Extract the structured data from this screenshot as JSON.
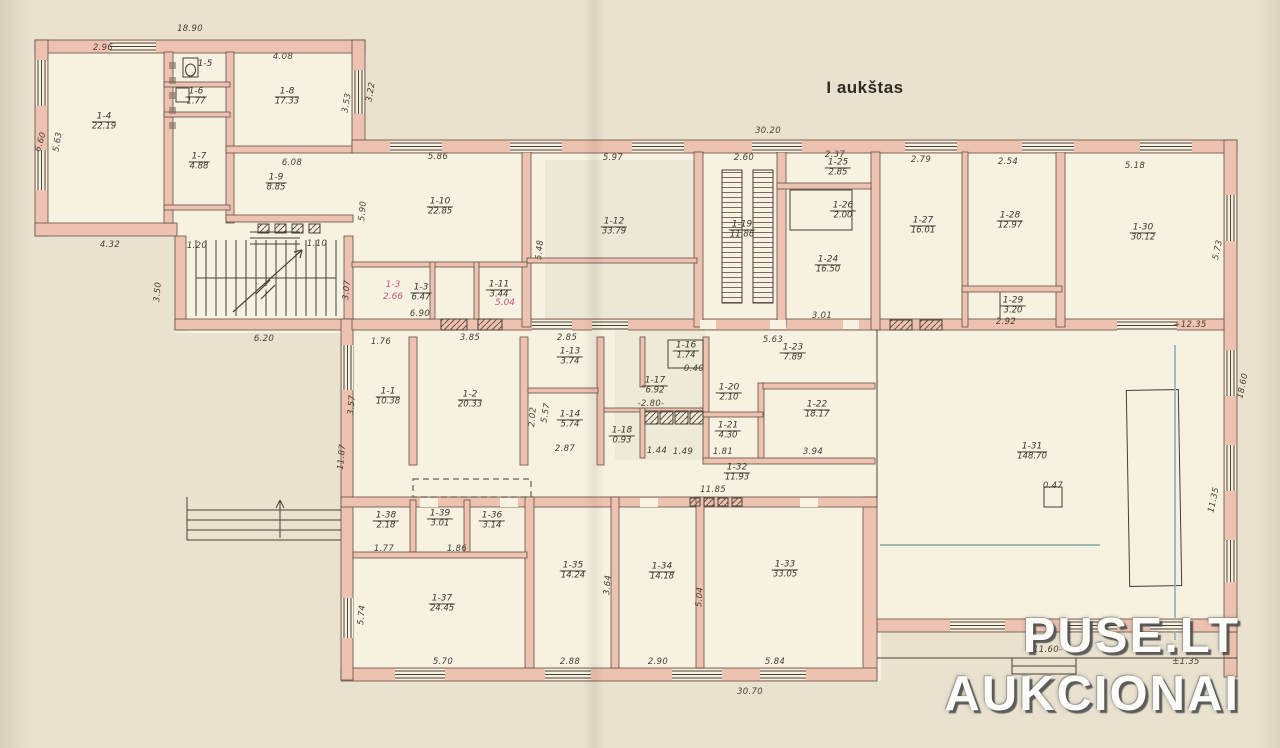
{
  "title": "I aukštas",
  "watermark": {
    "line1": "PUSE.LT",
    "line2": "AUKCIONAI"
  },
  "colors": {
    "wall": "#eec2b0",
    "wall_edge": "#5f4f44",
    "paper": "#f6f1e0",
    "background": "#e9e2cf",
    "line": "#4a4034",
    "red_note": "#c4567d",
    "blue_mark": "#8fb6c6",
    "teal_mark": "#86b0a2"
  },
  "rooms": [
    {
      "id": "1-4",
      "area": "22.19"
    },
    {
      "id": "1-5",
      "area": ""
    },
    {
      "id": "1-6",
      "area": "1.77"
    },
    {
      "id": "1-7",
      "area": "4.88"
    },
    {
      "id": "1-8",
      "area": "17.33"
    },
    {
      "id": "1-9",
      "area": "8.85"
    },
    {
      "id": "1-10",
      "area": "22.85"
    },
    {
      "id": "1-3",
      "area": "6.47"
    },
    {
      "id": "1-11",
      "area": "3.44"
    },
    {
      "id": "1-12",
      "area": "33.79"
    },
    {
      "id": "1-19",
      "area": "11.86"
    },
    {
      "id": "1-25",
      "area": "2.85"
    },
    {
      "id": "1-26",
      "area": "2.00"
    },
    {
      "id": "1-24",
      "area": "16.50"
    },
    {
      "id": "1-27",
      "area": "16.01"
    },
    {
      "id": "1-28",
      "area": "12.97"
    },
    {
      "id": "1-29",
      "area": "3.20"
    },
    {
      "id": "1-30",
      "area": "30.12"
    },
    {
      "id": "1-1",
      "area": "10.38"
    },
    {
      "id": "1-2",
      "area": "20.33"
    },
    {
      "id": "1-13",
      "area": "3.74"
    },
    {
      "id": "1-14",
      "area": "5.74"
    },
    {
      "id": "1-16",
      "area": "1.74"
    },
    {
      "id": "1-17",
      "area": "6.92"
    },
    {
      "id": "1-18",
      "area": "0.93"
    },
    {
      "id": "1-20",
      "area": "2.10"
    },
    {
      "id": "1-21",
      "area": "4.30"
    },
    {
      "id": "1-23",
      "area": "7.89"
    },
    {
      "id": "1-22",
      "area": "18.17"
    },
    {
      "id": "1-32",
      "area": "11.93"
    },
    {
      "id": "1-31",
      "area": "148.70"
    },
    {
      "id": "1-38",
      "area": "2.18"
    },
    {
      "id": "1-39",
      "area": "3.01"
    },
    {
      "id": "1-36",
      "area": "3.14"
    },
    {
      "id": "1-37",
      "area": "24.45"
    },
    {
      "id": "1-35",
      "area": "14.24"
    },
    {
      "id": "1-34",
      "area": "14.18"
    },
    {
      "id": "1-33",
      "area": "33.05"
    }
  ],
  "dimensions": [
    "18.90",
    "2.96",
    "4.08",
    "6.60",
    "5.63",
    "3.53",
    "3.22",
    "6.08",
    "4.32",
    "1.20",
    "1.10",
    "3.50",
    "3.07",
    "6.20",
    "30.20",
    "5.86",
    "5.97",
    "2.60",
    "2.37",
    "2.79",
    "2.54",
    "5.18",
    "5.90",
    "5.48",
    "3.01",
    "2.92",
    "5.73",
    "6.90",
    "1.76",
    "3.85",
    "2.85",
    "5.63",
    "3.57",
    "11.87",
    "5.57",
    "2.02",
    "2.87",
    "-2.80-",
    "3.94",
    "1.81",
    "11.85",
    "1.77",
    "1.86",
    "5.74",
    "5.70",
    "2.88",
    "2.90",
    "5.84",
    "30.70",
    "3.64",
    "5.04",
    "11.35",
    "18.60",
    "+12.35",
    "-11.60-",
    "0.47",
    "±1.35",
    "0.40",
    "1.44",
    "1.49"
  ],
  "red_notes": [
    "1-3",
    "2.66",
    "5.04"
  ]
}
